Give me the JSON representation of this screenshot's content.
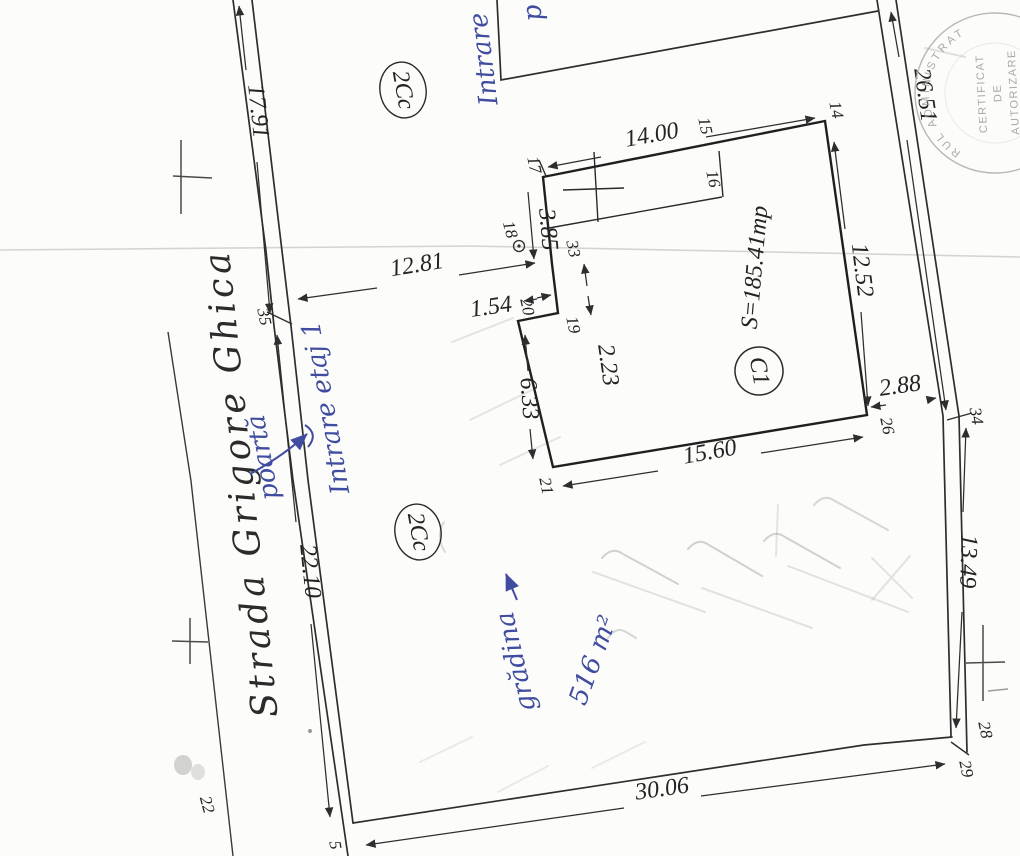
{
  "plan": {
    "street_name": "Strada Grigore Ghica",
    "zone_code": "2Cc",
    "building": {
      "code": "C1",
      "area": "S=185.41mp"
    },
    "boundary_dimensions": {
      "west_upper": "17.91",
      "west_lower": "22.10",
      "east_upper": "26.51",
      "east_lower": "13.49",
      "south": "30.06",
      "street_to_building": "12.81",
      "building_to_east": "2.88"
    },
    "building_dimensions": {
      "north": "14.00",
      "east": "12.52",
      "south": "15.60",
      "west_upper": "3.85",
      "notch_width": "1.54",
      "notch_height": "2.23",
      "west_lower": "6.33"
    },
    "point_numbers": {
      "p5": "5",
      "p14": "14",
      "p15": "15",
      "p16": "16",
      "p17": "17",
      "p18": "18",
      "p19": "19",
      "p20": "20",
      "p21": "21",
      "p22": "22",
      "p26": "26",
      "p28": "28",
      "p29": "29",
      "p33": "33",
      "p34": "34",
      "p35": "35"
    },
    "handwriting": {
      "top_note": "Intrare",
      "top_note_2": "p",
      "gate_note": "poartă",
      "entrance_note": "Intrare etaj 1",
      "garden_note": "grădina",
      "garden_area": "516 m²"
    },
    "stamp": {
      "rim_text": "RUL ADMINISTRAT",
      "line1": "CERTIFICAT",
      "line2": "DE",
      "line3": "AUTORIZARE",
      "line4": "· 2004"
    }
  }
}
